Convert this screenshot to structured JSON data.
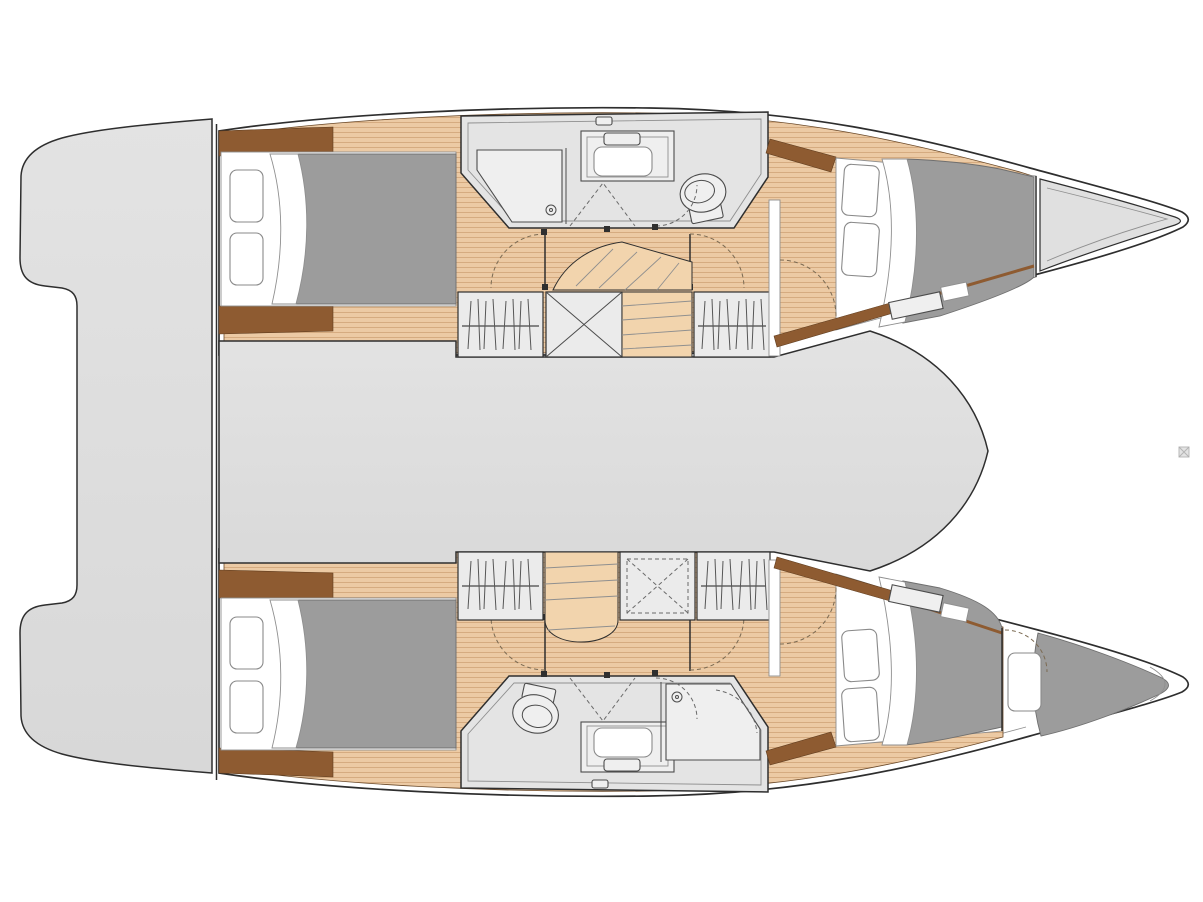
{
  "document": {
    "kind": "yacht-floor-plan",
    "vessel_type": "sailing-catamaran",
    "view": "top-down interior deck plan",
    "orientation": "bow-right-stern-left",
    "visible_text": []
  },
  "colors": {
    "background": "#ffffff",
    "line": "#2e2e2e",
    "line-soft": "#8f8f8f",
    "deck": "#e0e0e0",
    "deck-shade": "#d5d5d5",
    "room": "#e4e4e4",
    "cabinet": "#ebebeb",
    "fixture": "#efefef",
    "wood": "#eccaa4",
    "wood-line": "#d3a87c",
    "wood-dark": "#8e5b31",
    "step": "#f2d4ad",
    "duvet": "#9c9c9c",
    "duvet-line": "#6f6f6f",
    "white": "#ffffff",
    "dash": "#7b6a52",
    "mark": "#aaaaaa"
  },
  "inventory": {
    "hulls": 2,
    "double_cabins": 4,
    "bow_berths": 1,
    "bathrooms": 2,
    "toilets": 2,
    "showers": 2,
    "vanity_sinks": 2,
    "hanging_lockers": 4,
    "storage_lockers": 2,
    "staircases": 2,
    "aft_cockpit": 1,
    "saloon_bridgedeck": 1,
    "foredecks": 1,
    "pillows_visible": 9
  },
  "features": [
    {
      "name": "aft-cockpit",
      "label": "aft cockpit platform"
    },
    {
      "name": "saloon",
      "label": "central saloon / bridgedeck"
    },
    {
      "name": "hull-port",
      "label": "port hull (top)"
    },
    {
      "name": "hull-starboard",
      "label": "starboard hull (bottom)"
    },
    {
      "name": "port-aft-cabin",
      "label": "port aft double cabin"
    },
    {
      "name": "port-head",
      "label": "port bathroom with shower, vanity and toilet"
    },
    {
      "name": "port-forward-cabin",
      "label": "port forward double cabin"
    },
    {
      "name": "foredeck",
      "label": "port bow foredeck locker"
    },
    {
      "name": "starboard-aft-cabin",
      "label": "starboard aft double cabin"
    },
    {
      "name": "starboard-head",
      "label": "starboard bathroom with toilet, vanity and shower"
    },
    {
      "name": "starboard-forward-cabin",
      "label": "starboard forward double cabin"
    },
    {
      "name": "bow-berth",
      "label": "starboard bow single berth"
    }
  ]
}
